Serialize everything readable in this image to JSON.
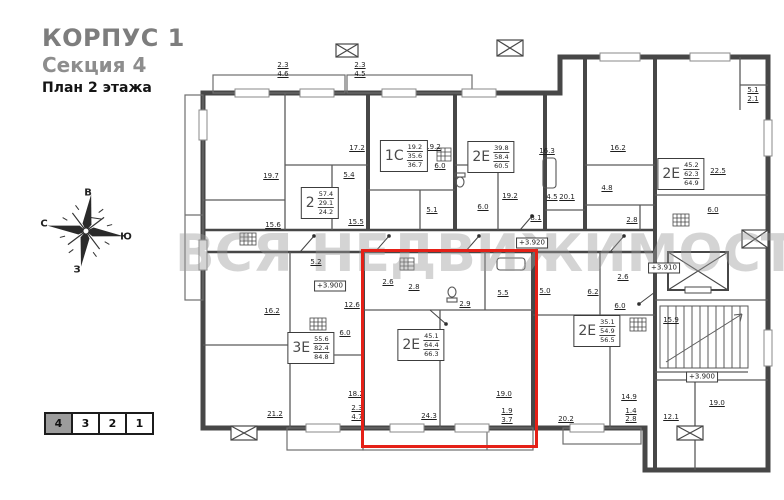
{
  "header": {
    "building": "КОРПУС 1",
    "section": "Секция 4",
    "floor": "План 2 этажа"
  },
  "watermark": {
    "text": "ВСЯ НЕДВИЖИМОСТЬ"
  },
  "compass": {
    "top": "В",
    "left": "С",
    "right": "Ю",
    "bottom": "З"
  },
  "section_selector": {
    "items": [
      {
        "label": "4",
        "selected": true
      },
      {
        "label": "3",
        "selected": false
      },
      {
        "label": "2",
        "selected": false
      },
      {
        "label": "1",
        "selected": false
      }
    ]
  },
  "plan": {
    "highlight_color": "#e52017",
    "apartments": [
      {
        "type": "2",
        "areas": [
          "57.4",
          "29.1",
          "24.2"
        ],
        "x": 320,
        "y": 203,
        "highlighted": false
      },
      {
        "type": "1С",
        "areas": [
          "19.2",
          "35.6",
          "36.7"
        ],
        "x": 404,
        "y": 156,
        "highlighted": false
      },
      {
        "type": "2Е",
        "areas": [
          "39.8",
          "58.4",
          "60.5"
        ],
        "x": 491,
        "y": 157,
        "highlighted": false
      },
      {
        "type": "2Е",
        "areas": [
          "45.2",
          "62.3",
          "64.9"
        ],
        "x": 681,
        "y": 174,
        "highlighted": false
      },
      {
        "type": "3Е",
        "areas": [
          "55.6",
          "82.4",
          "84.8"
        ],
        "x": 311,
        "y": 348,
        "highlighted": false
      },
      {
        "type": "2Е",
        "areas": [
          "45.1",
          "64.4",
          "66.3"
        ],
        "x": 421,
        "y": 345,
        "highlighted": true
      },
      {
        "type": "2Е",
        "areas": [
          "35.1",
          "54.9",
          "56.5"
        ],
        "x": 597,
        "y": 331,
        "highlighted": false
      }
    ],
    "levels": [
      {
        "t": "+3.920",
        "x": 532,
        "y": 243
      },
      {
        "t": "+3.900",
        "x": 330,
        "y": 286
      },
      {
        "t": "+3.910",
        "x": 664,
        "y": 268
      },
      {
        "t": "+3.900",
        "x": 702,
        "y": 377
      }
    ],
    "rooms": [
      {
        "t": "2.3",
        "x": 283,
        "y": 65
      },
      {
        "t": "4.6",
        "x": 283,
        "y": 74
      },
      {
        "t": "2.3",
        "x": 360,
        "y": 65
      },
      {
        "t": "4.5",
        "x": 360,
        "y": 74
      },
      {
        "t": "19.7",
        "x": 271,
        "y": 176
      },
      {
        "t": "17.2",
        "x": 357,
        "y": 148
      },
      {
        "t": "5.4",
        "x": 349,
        "y": 175
      },
      {
        "t": "15.6",
        "x": 273,
        "y": 225
      },
      {
        "t": "15.5",
        "x": 356,
        "y": 222
      },
      {
        "t": "19.2",
        "x": 433,
        "y": 147
      },
      {
        "t": "6.0",
        "x": 440,
        "y": 166
      },
      {
        "t": "5.1",
        "x": 432,
        "y": 210
      },
      {
        "t": "19.2",
        "x": 510,
        "y": 196
      },
      {
        "t": "6.0",
        "x": 483,
        "y": 207
      },
      {
        "t": "8.1",
        "x": 536,
        "y": 218
      },
      {
        "t": "4.5",
        "x": 552,
        "y": 197
      },
      {
        "t": "16.3",
        "x": 547,
        "y": 151
      },
      {
        "t": "20.1",
        "x": 567,
        "y": 197
      },
      {
        "t": "16.2",
        "x": 618,
        "y": 148
      },
      {
        "t": "4.8",
        "x": 607,
        "y": 188
      },
      {
        "t": "2.8",
        "x": 632,
        "y": 220
      },
      {
        "t": "22.5",
        "x": 718,
        "y": 171
      },
      {
        "t": "6.0",
        "x": 713,
        "y": 210
      },
      {
        "t": "5.1",
        "x": 753,
        "y": 90
      },
      {
        "t": "2.1",
        "x": 753,
        "y": 99
      },
      {
        "t": "5.2",
        "x": 316,
        "y": 262
      },
      {
        "t": "12.6",
        "x": 352,
        "y": 305
      },
      {
        "t": "2.6",
        "x": 388,
        "y": 282
      },
      {
        "t": "2.8",
        "x": 414,
        "y": 287
      },
      {
        "t": "2.9",
        "x": 465,
        "y": 304
      },
      {
        "t": "5.5",
        "x": 503,
        "y": 293
      },
      {
        "t": "5.0",
        "x": 545,
        "y": 291
      },
      {
        "t": "6.2",
        "x": 593,
        "y": 292
      },
      {
        "t": "6.0",
        "x": 620,
        "y": 306
      },
      {
        "t": "2.6",
        "x": 623,
        "y": 277
      },
      {
        "t": "16.2",
        "x": 272,
        "y": 311
      },
      {
        "t": "6.0",
        "x": 345,
        "y": 333
      },
      {
        "t": "21.2",
        "x": 275,
        "y": 414
      },
      {
        "t": "18.2",
        "x": 356,
        "y": 394
      },
      {
        "t": "2.3",
        "x": 357,
        "y": 408
      },
      {
        "t": "4.7",
        "x": 357,
        "y": 417
      },
      {
        "t": "24.3",
        "x": 429,
        "y": 416
      },
      {
        "t": "19.0",
        "x": 504,
        "y": 394
      },
      {
        "t": "1.9",
        "x": 507,
        "y": 411
      },
      {
        "t": "3.7",
        "x": 507,
        "y": 420
      },
      {
        "t": "20.2",
        "x": 566,
        "y": 419
      },
      {
        "t": "14.9",
        "x": 629,
        "y": 397
      },
      {
        "t": "1.4",
        "x": 631,
        "y": 411
      },
      {
        "t": "2.8",
        "x": 631,
        "y": 419
      },
      {
        "t": "15.9",
        "x": 671,
        "y": 320
      },
      {
        "t": "19.0",
        "x": 717,
        "y": 403
      },
      {
        "t": "12.1",
        "x": 671,
        "y": 417
      }
    ]
  }
}
